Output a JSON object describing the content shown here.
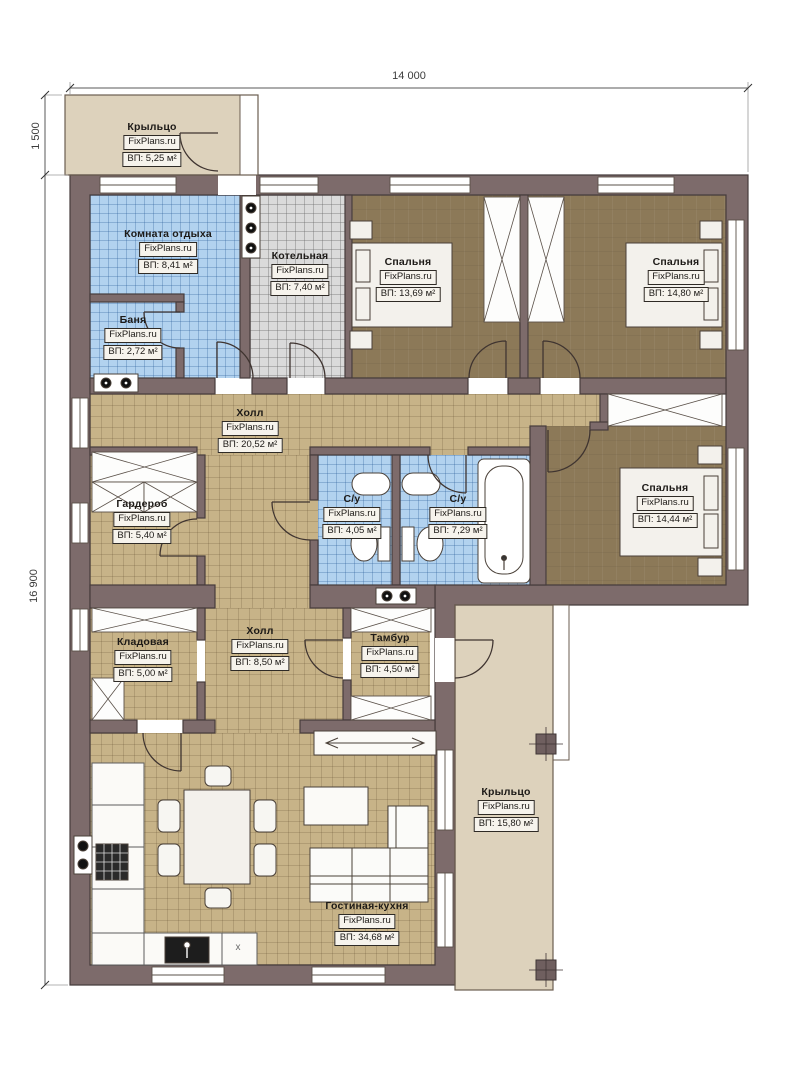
{
  "brand": "FixPlans.ru",
  "dimensions": {
    "width_total": "14 000",
    "height_main": "16 900",
    "height_porch": "1 500"
  },
  "symbols": {
    "kitchen_marker": "x"
  },
  "rooms": {
    "porch_top": {
      "name": "Крыльцо",
      "area": "ВП: 5,25 м²"
    },
    "lounge": {
      "name": "Комната отдыха",
      "area": "ВП: 8,41 м²"
    },
    "boiler": {
      "name": "Котельная",
      "area": "ВП: 7,40 м²"
    },
    "bath": {
      "name": "Баня",
      "area": "ВП: 2,72 м²"
    },
    "bedroom1": {
      "name": "Спальня",
      "area": "ВП: 13,69 м²"
    },
    "bedroom2": {
      "name": "Спальня",
      "area": "ВП: 14,80 м²"
    },
    "hall_main": {
      "name": "Холл",
      "area": "ВП: 20,52 м²"
    },
    "wardrobe": {
      "name": "Гардероб",
      "area": "ВП: 5,40 м²"
    },
    "wc_small": {
      "name": "С/у",
      "area": "ВП: 4,05 м²"
    },
    "wc_big": {
      "name": "С/у",
      "area": "ВП: 7,29 м²"
    },
    "bedroom3": {
      "name": "Спальня",
      "area": "ВП: 14,44 м²"
    },
    "storage": {
      "name": "Кладовая",
      "area": "ВП: 5,00 м²"
    },
    "hall_small": {
      "name": "Холл",
      "area": "ВП: 8,50 м²"
    },
    "tambour": {
      "name": "Тамбур",
      "area": "ВП: 4,50 м²"
    },
    "porch_bottom": {
      "name": "Крыльцо",
      "area": "ВП: 15,80 м²"
    },
    "living": {
      "name": "Гостиная-кухня",
      "area": "ВП: 34,68 м²"
    }
  },
  "colors": {
    "wall": "#7d6b6b",
    "wall_outline": "#463c3c",
    "floor_wood": "#c7b388",
    "floor_bedroom": "#8c7958",
    "floor_tile_blue": "#b2d2ef",
    "floor_tile_gray": "#dadada",
    "porch": "#ddd2bc"
  }
}
